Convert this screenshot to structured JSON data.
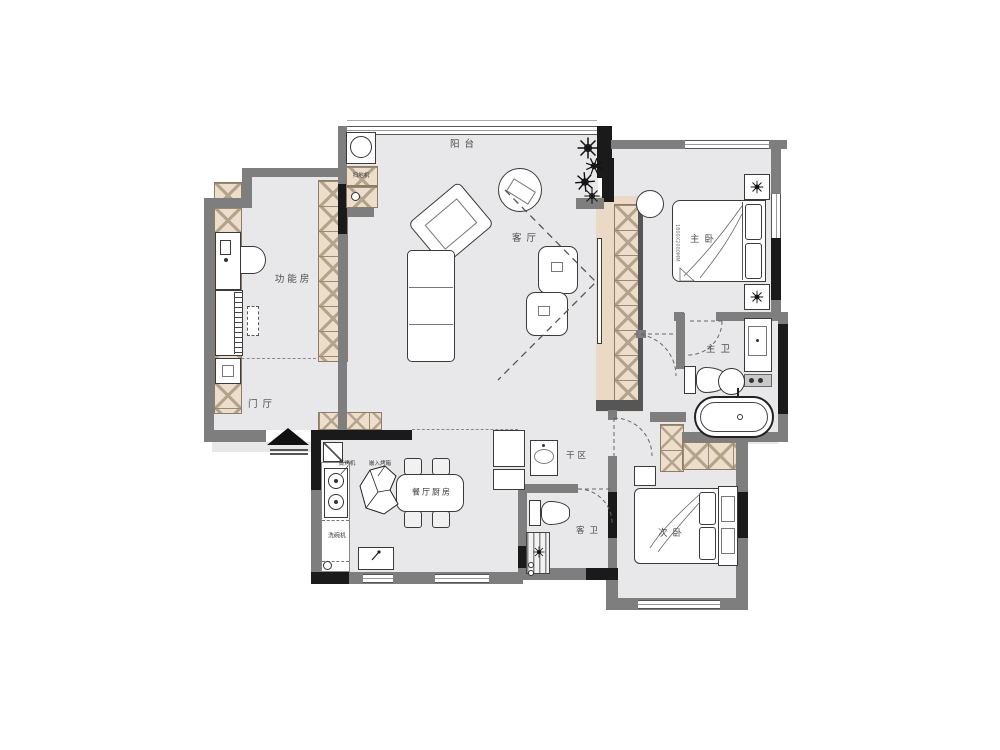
{
  "rooms": {
    "balcony": {
      "label": "阳台"
    },
    "living_room": {
      "label": "客厅"
    },
    "master_bedroom": {
      "label": "主卧"
    },
    "master_bath": {
      "label": "主卫"
    },
    "function_room": {
      "label": "功能房"
    },
    "foyer": {
      "label": "门厅"
    },
    "dining_kitchen": {
      "label": "餐厅厨房"
    },
    "dry_area": {
      "label": "干区"
    },
    "guest_bath": {
      "label": "客卫"
    },
    "second_bedroom": {
      "label": "次卧"
    }
  },
  "appliances": {
    "robot_vacuum": {
      "label": "扫地机"
    },
    "dishwasher": {
      "label": "洗碗机"
    },
    "steam_oven": {
      "label": "蒸烤机"
    },
    "built_in_oven": {
      "label": "嵌入烤箱"
    }
  },
  "dimensions": {
    "master_bed": "1800X2000MM"
  },
  "colors": {
    "wall": "#7e7e7e",
    "column": "#1a1a1a",
    "floor": "#e8e8ea",
    "cabinet_fill": "#ecdecb",
    "cabinet_line": "#a8977f",
    "furniture_outline": "#3a3a3a"
  }
}
